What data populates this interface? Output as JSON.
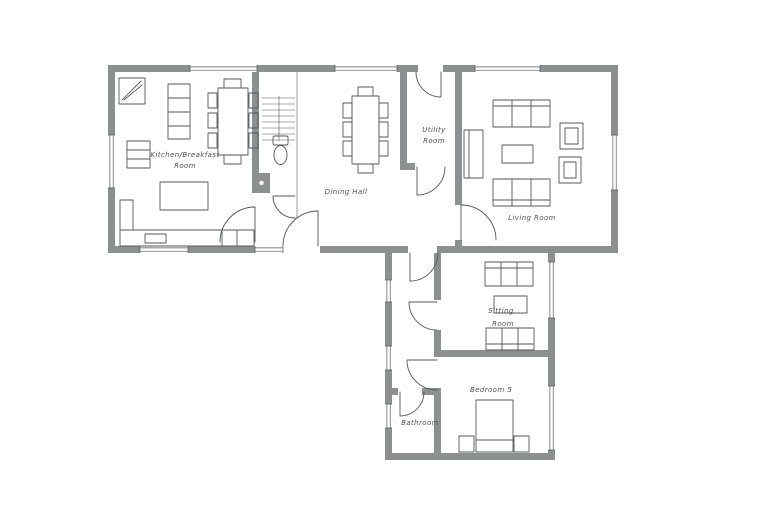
{
  "plan": {
    "type": "floor-plan-sketch",
    "colors": {
      "wall": "#8d9091",
      "line": "#55585a",
      "label": "#4e5254",
      "background": "#ffffff"
    },
    "rooms": {
      "kitchen": {
        "label_line1": "Kitchen/Breakfast",
        "label_line2": "Room"
      },
      "dining": {
        "label": "Dining Hall"
      },
      "utility": {
        "label_line1": "Utility",
        "label_line2": "Room"
      },
      "living": {
        "label": "Living Room"
      },
      "sitting": {
        "label_line1": "Sitting",
        "label_line2": "Room"
      },
      "bedroom5": {
        "label": "Bedroom 5"
      },
      "bathroom": {
        "label": "Bathroom"
      }
    }
  }
}
